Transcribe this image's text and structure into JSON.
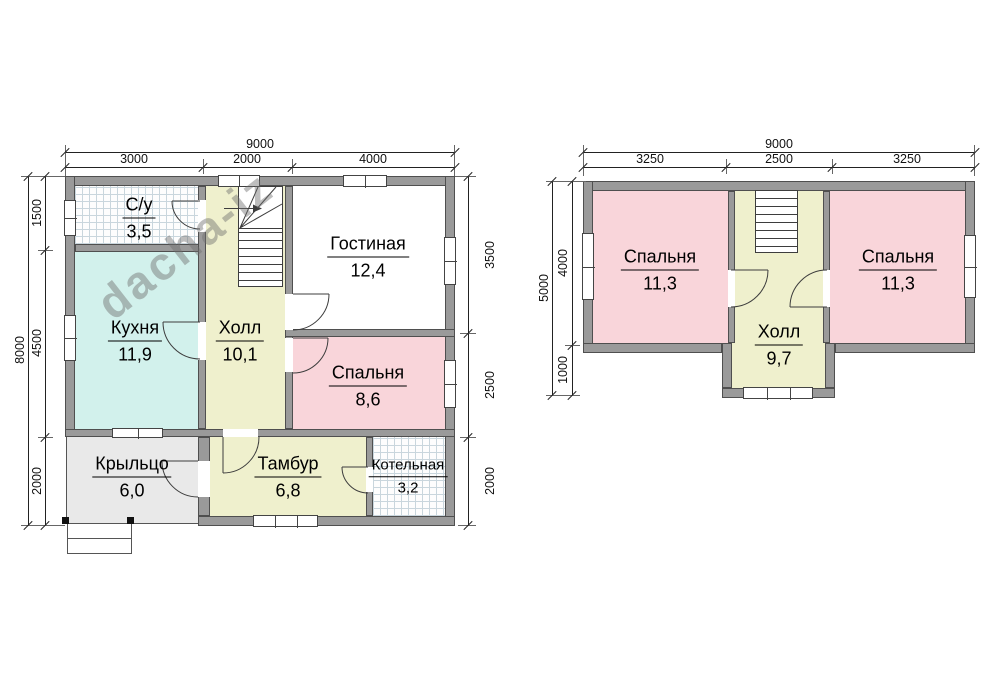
{
  "watermark": {
    "text": "dacha-iz"
  },
  "floor1": {
    "dims": {
      "width_total": "9000",
      "width_segments": [
        "3000",
        "2000",
        "4000"
      ],
      "height_total": "8000",
      "height_left_segments": [
        "1500",
        "4500",
        "2000"
      ],
      "height_right_segments": [
        "3500",
        "2500",
        "2000"
      ]
    },
    "rooms": [
      {
        "name": "С/у",
        "area": "3,5"
      },
      {
        "name": "Кухня",
        "area": "11,9"
      },
      {
        "name": "Холл",
        "area": "10,1"
      },
      {
        "name": "Гостиная",
        "area": "12,4"
      },
      {
        "name": "Спальня",
        "area": "8,6"
      },
      {
        "name": "Крыльцо",
        "area": "6,0"
      },
      {
        "name": "Тамбур",
        "area": "6,8"
      },
      {
        "name": "Котельная",
        "area": "3,2"
      }
    ]
  },
  "floor2": {
    "dims": {
      "width_total": "9000",
      "width_segments": [
        "3250",
        "2500",
        "3250"
      ],
      "height_total": "5000",
      "height_left_segments": [
        "4000",
        "1000"
      ]
    },
    "rooms": [
      {
        "name": "Спальня",
        "area": "11,3"
      },
      {
        "name": "Холл",
        "area": "9,7"
      },
      {
        "name": "Спальня",
        "area": "11,3"
      }
    ]
  },
  "colors": {
    "wall": "#9a9a9a",
    "hall_fill": "#eff0cd",
    "kitchen_fill": "#d2f1ec",
    "bedroom_fill": "#f9d5da",
    "porch_fill": "#e9e9e9"
  }
}
